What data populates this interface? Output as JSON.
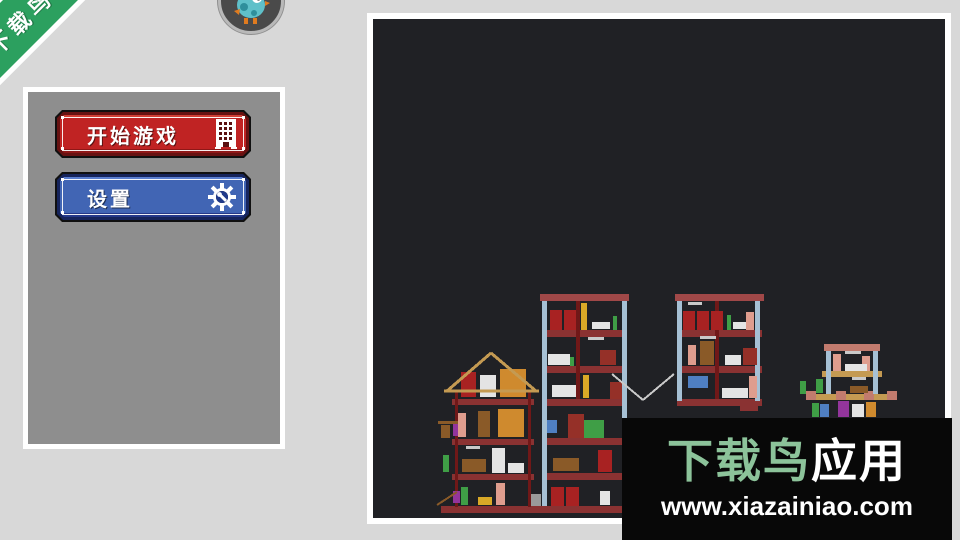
{
  "background_color": "#d8d8d8",
  "ribbon": {
    "label": "下载鸟",
    "color": "#2ca05f"
  },
  "logo_badge": {
    "icon": "bird-mascot",
    "ring_color": "#b9b9b9"
  },
  "menu": {
    "start_button": {
      "label": "开始游戏",
      "face_color": "#c02323",
      "border_color": "#671212",
      "icon": "building-icon"
    },
    "settings_button": {
      "label": "设置",
      "face_color": "#4165b4",
      "border_color": "#16245c",
      "icon": "gear-icon"
    }
  },
  "watermark": {
    "brand_green": "下载鸟",
    "brand_suffix": "应用",
    "url": "www.xiazainiao.com",
    "green_color": "#8cc39a",
    "background": "#080808"
  },
  "scene": {
    "background": "#202125",
    "palette": {
      "brick": "#8a3232",
      "topband": "#a04848",
      "wallRed": "#701818",
      "colBlue": "#a6c0d4",
      "tan": "#c49a52",
      "barrel": "#a82222",
      "crate": "#cf8a2e",
      "white": "#e4e4e4",
      "green": "#3f9e46",
      "pink": "#df9d8e",
      "purple": "#93359c",
      "doorRed": "#953028",
      "brown": "#8a5a28",
      "yellow": "#d9a927",
      "blueItem": "#4f7fc2",
      "gray": "#9a9a9a",
      "pinkBrick": "#c27b6e",
      "ltGray": "#c9c9c9"
    },
    "rects": [
      [
        441,
        506,
        181,
        7,
        "brick"
      ],
      [
        528,
        494,
        13,
        12,
        "gray"
      ],
      [
        452,
        399,
        82,
        6,
        "brick"
      ],
      [
        452,
        439,
        82,
        6,
        "brick"
      ],
      [
        452,
        474,
        82,
        6,
        "brick"
      ],
      [
        455,
        391,
        3,
        116,
        "wallRed"
      ],
      [
        528,
        391,
        3,
        116,
        "wallRed"
      ],
      [
        453,
        424,
        7,
        12,
        "purple"
      ],
      [
        453,
        491,
        7,
        12,
        "purple"
      ],
      [
        461,
        372,
        15,
        25,
        "barrel"
      ],
      [
        480,
        375,
        16,
        22,
        "white"
      ],
      [
        500,
        369,
        26,
        28,
        "crate"
      ],
      [
        498,
        409,
        26,
        28,
        "crate"
      ],
      [
        478,
        411,
        12,
        26,
        "brown"
      ],
      [
        458,
        413,
        8,
        24,
        "pink"
      ],
      [
        438,
        421,
        20,
        3,
        "brown"
      ],
      [
        441,
        425,
        9,
        13,
        "brown"
      ],
      [
        443,
        455,
        6,
        17,
        "green"
      ],
      [
        492,
        448,
        13,
        25,
        "white"
      ],
      [
        462,
        459,
        24,
        13,
        "brown"
      ],
      [
        508,
        463,
        16,
        10,
        "white"
      ],
      [
        461,
        487,
        7,
        18,
        "green"
      ],
      [
        496,
        483,
        9,
        22,
        "pink"
      ],
      [
        478,
        497,
        14,
        8,
        "yellow"
      ],
      [
        466,
        446,
        14,
        3,
        "ltGray"
      ],
      [
        540,
        294,
        89,
        7,
        "topband"
      ],
      [
        542,
        330,
        85,
        7,
        "brick"
      ],
      [
        542,
        366,
        85,
        7,
        "brick"
      ],
      [
        542,
        399,
        85,
        7,
        "brick"
      ],
      [
        542,
        438,
        85,
        7,
        "brick"
      ],
      [
        542,
        473,
        85,
        7,
        "brick"
      ],
      [
        542,
        301,
        5,
        205,
        "colBlue"
      ],
      [
        622,
        301,
        5,
        205,
        "colBlue"
      ],
      [
        576,
        301,
        4,
        98,
        "wallRed"
      ],
      [
        550,
        310,
        12,
        20,
        "barrel"
      ],
      [
        564,
        310,
        12,
        20,
        "barrel"
      ],
      [
        581,
        303,
        6,
        27,
        "yellow"
      ],
      [
        592,
        322,
        18,
        7,
        "white"
      ],
      [
        613,
        316,
        4,
        14,
        "green"
      ],
      [
        548,
        354,
        22,
        11,
        "white"
      ],
      [
        600,
        350,
        16,
        15,
        "doorRed"
      ],
      [
        570,
        357,
        4,
        9,
        "green"
      ],
      [
        588,
        337,
        16,
        3,
        "ltGray"
      ],
      [
        552,
        385,
        24,
        12,
        "white"
      ],
      [
        583,
        375,
        6,
        23,
        "yellow"
      ],
      [
        610,
        382,
        12,
        17,
        "doorRed"
      ],
      [
        547,
        420,
        10,
        13,
        "blueItem"
      ],
      [
        568,
        414,
        16,
        24,
        "doorRed"
      ],
      [
        584,
        420,
        20,
        18,
        "green"
      ],
      [
        553,
        458,
        26,
        13,
        "brown"
      ],
      [
        598,
        450,
        14,
        22,
        "barrel"
      ],
      [
        551,
        487,
        13,
        19,
        "barrel"
      ],
      [
        566,
        487,
        13,
        19,
        "barrel"
      ],
      [
        600,
        491,
        10,
        14,
        "white"
      ],
      [
        675,
        294,
        89,
        7,
        "topband"
      ],
      [
        677,
        330,
        85,
        7,
        "brick"
      ],
      [
        677,
        366,
        85,
        7,
        "brick"
      ],
      [
        677,
        399,
        85,
        7,
        "brick"
      ],
      [
        677,
        301,
        5,
        100,
        "colBlue"
      ],
      [
        755,
        301,
        5,
        100,
        "colBlue"
      ],
      [
        715,
        301,
        4,
        98,
        "wallRed"
      ],
      [
        683,
        311,
        12,
        19,
        "barrel"
      ],
      [
        697,
        311,
        12,
        19,
        "barrel"
      ],
      [
        711,
        311,
        12,
        19,
        "barrel"
      ],
      [
        727,
        315,
        4,
        15,
        "green"
      ],
      [
        733,
        322,
        16,
        7,
        "white"
      ],
      [
        746,
        312,
        8,
        18,
        "pink"
      ],
      [
        688,
        302,
        14,
        3,
        "ltGray"
      ],
      [
        700,
        341,
        14,
        24,
        "brown"
      ],
      [
        688,
        345,
        8,
        20,
        "pink"
      ],
      [
        725,
        355,
        16,
        10,
        "white"
      ],
      [
        743,
        348,
        14,
        17,
        "doorRed"
      ],
      [
        700,
        336,
        16,
        3,
        "ltGray"
      ],
      [
        688,
        376,
        20,
        12,
        "blueItem"
      ],
      [
        722,
        388,
        26,
        10,
        "white"
      ],
      [
        749,
        376,
        8,
        22,
        "pink"
      ],
      [
        740,
        404,
        18,
        7,
        "brick"
      ],
      [
        824,
        344,
        56,
        7,
        "pinkBrick"
      ],
      [
        822,
        371,
        60,
        6,
        "tan"
      ],
      [
        806,
        394,
        91,
        6,
        "tan"
      ],
      [
        806,
        391,
        10,
        9,
        "pinkBrick"
      ],
      [
        836,
        391,
        10,
        9,
        "pinkBrick"
      ],
      [
        864,
        391,
        10,
        9,
        "pinkBrick"
      ],
      [
        887,
        391,
        10,
        9,
        "pinkBrick"
      ],
      [
        826,
        351,
        5,
        43,
        "colBlue"
      ],
      [
        873,
        351,
        5,
        43,
        "colBlue"
      ],
      [
        833,
        354,
        8,
        17,
        "pink"
      ],
      [
        862,
        356,
        8,
        15,
        "pink"
      ],
      [
        845,
        364,
        22,
        7,
        "white"
      ],
      [
        845,
        351,
        16,
        3,
        "ltGray"
      ],
      [
        816,
        379,
        7,
        14,
        "green"
      ],
      [
        800,
        381,
        6,
        13,
        "green"
      ],
      [
        850,
        386,
        18,
        7,
        "brown"
      ],
      [
        852,
        377,
        14,
        3,
        "ltGray"
      ],
      [
        812,
        403,
        7,
        14,
        "green"
      ],
      [
        820,
        404,
        9,
        13,
        "blueItem"
      ],
      [
        838,
        401,
        11,
        16,
        "purple"
      ],
      [
        852,
        404,
        12,
        13,
        "white"
      ],
      [
        866,
        402,
        10,
        15,
        "crate"
      ]
    ],
    "lines": [
      [
        447,
        391,
        491,
        353,
        "tan",
        3
      ],
      [
        491,
        353,
        536,
        391,
        "tan",
        3
      ],
      [
        444,
        391,
        539,
        391,
        "tan",
        3
      ],
      [
        612,
        374,
        643,
        400,
        "ltGray",
        2
      ],
      [
        643,
        400,
        674,
        374,
        "ltGray",
        2
      ],
      [
        437,
        505,
        457,
        492,
        "brown",
        2
      ]
    ]
  }
}
